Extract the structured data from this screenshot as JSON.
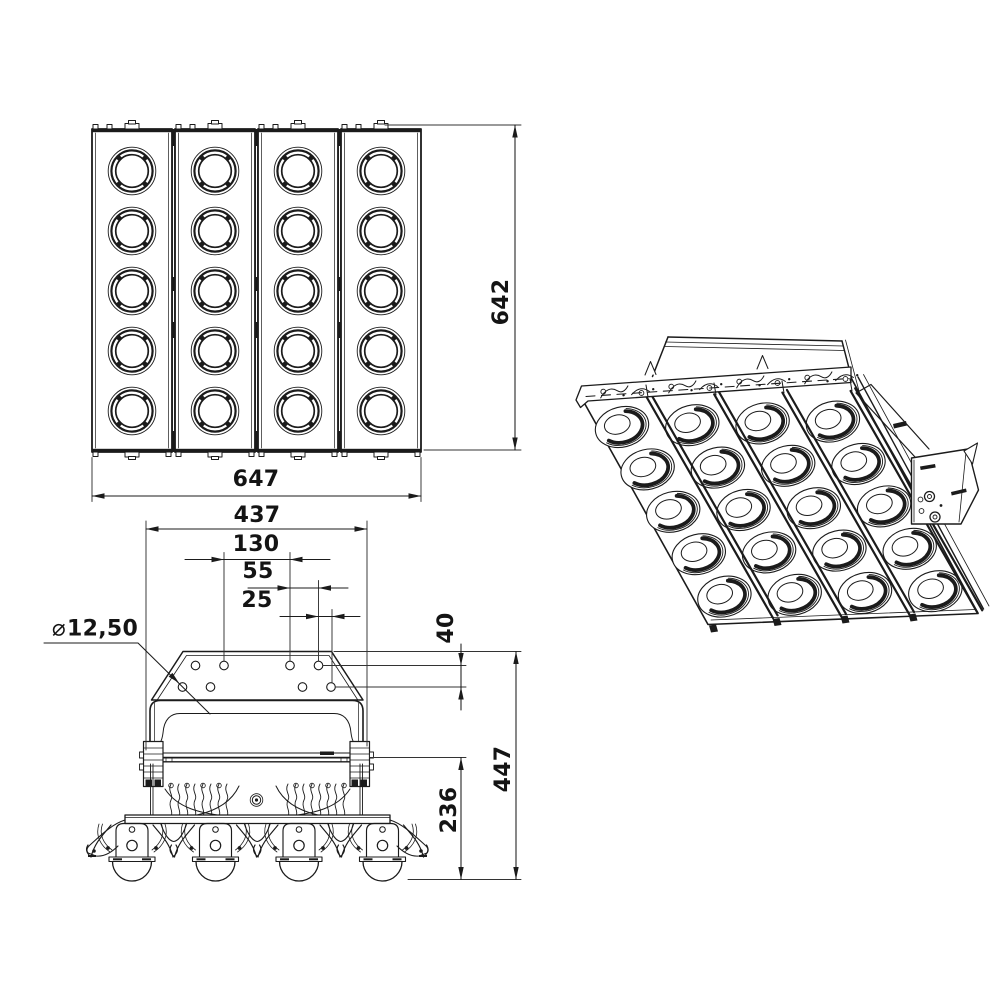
{
  "dimensions": {
    "front_view": {
      "width": "647",
      "height": "642"
    },
    "mounting_plate": {
      "overall_width": "437",
      "hole_pitch_large": "130",
      "hole_pitch_medium": "55",
      "hole_pitch_small": "25",
      "hole_diameter_symbol": "⌀",
      "hole_diameter_value": "12,50",
      "hole_row_offset": "40"
    },
    "side_view": {
      "overall_height": "447",
      "lower_section_height": "236"
    }
  },
  "colors": {
    "line": "#1b1b1b",
    "background": "#ffffff"
  }
}
